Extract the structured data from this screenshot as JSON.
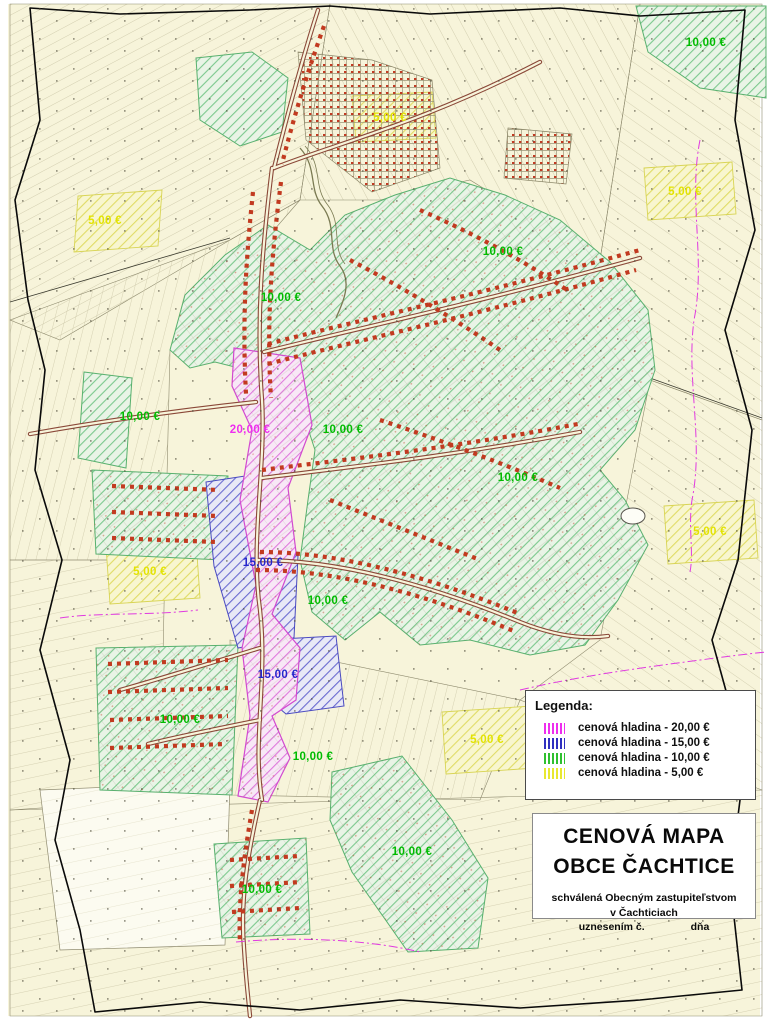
{
  "colors": {
    "map_background": "#f7f4da",
    "boundary": "#0a0a0a",
    "road": "#8a4838",
    "buildings": "#c23a20",
    "level_20": "#ee2eee",
    "level_15": "#2626cc",
    "level_10": "#00bb00",
    "level_5": "#e3e300"
  },
  "legend": {
    "title": "Legenda:",
    "items": [
      {
        "label": "cenová hladina - 20,00 €",
        "color": "#ee2eee"
      },
      {
        "label": "cenová hladina - 15,00 €",
        "color": "#3030c0"
      },
      {
        "label": "cenová hladina - 10,00 €",
        "color": "#30c030"
      },
      {
        "label": "cenová hladina - 5,00 €",
        "color": "#e8e830"
      }
    ]
  },
  "title_block": {
    "title_line1": "CENOVÁ MAPA",
    "title_line2": "OBCE ČACHTICE",
    "approval_line1": "schválená Obecným zastupiteľstvom",
    "approval_line2": "v Čachticiach",
    "approval_line3_left": "uznesením č.",
    "approval_line3_right": "dňa"
  },
  "price_labels": [
    {
      "text": "10,00 €",
      "x": 706,
      "y": 43,
      "color": "#00bb00"
    },
    {
      "text": "5,00 €",
      "x": 390,
      "y": 118,
      "color": "#e3e300"
    },
    {
      "text": "5,00 €",
      "x": 685,
      "y": 192,
      "color": "#e3e300"
    },
    {
      "text": "5,00 €",
      "x": 105,
      "y": 221,
      "color": "#e3e300"
    },
    {
      "text": "10,00 €",
      "x": 503,
      "y": 252,
      "color": "#00bb00"
    },
    {
      "text": "10,00 €",
      "x": 281,
      "y": 298,
      "color": "#00bb00"
    },
    {
      "text": "10,00 €",
      "x": 140,
      "y": 417,
      "color": "#00bb00"
    },
    {
      "text": "20,00 €",
      "x": 250,
      "y": 430,
      "color": "#ee2eee"
    },
    {
      "text": "10,00 €",
      "x": 343,
      "y": 430,
      "color": "#00bb00"
    },
    {
      "text": "10,00 €",
      "x": 518,
      "y": 478,
      "color": "#00bb00"
    },
    {
      "text": "5,00 €",
      "x": 710,
      "y": 532,
      "color": "#e3e300"
    },
    {
      "text": "15,00 €",
      "x": 263,
      "y": 563,
      "color": "#2626cc"
    },
    {
      "text": "5,00 €",
      "x": 150,
      "y": 572,
      "color": "#e3e300"
    },
    {
      "text": "10,00 €",
      "x": 328,
      "y": 601,
      "color": "#00bb00"
    },
    {
      "text": "15,00 €",
      "x": 278,
      "y": 675,
      "color": "#2626cc"
    },
    {
      "text": "10,00 €",
      "x": 180,
      "y": 720,
      "color": "#00bb00"
    },
    {
      "text": "5,00 €",
      "x": 487,
      "y": 740,
      "color": "#e3e300"
    },
    {
      "text": "10,00 €",
      "x": 313,
      "y": 757,
      "color": "#00bb00"
    },
    {
      "text": "10,00 €",
      "x": 412,
      "y": 852,
      "color": "#00bb00"
    },
    {
      "text": "10,00 €",
      "x": 262,
      "y": 890,
      "color": "#00bb00"
    }
  ]
}
